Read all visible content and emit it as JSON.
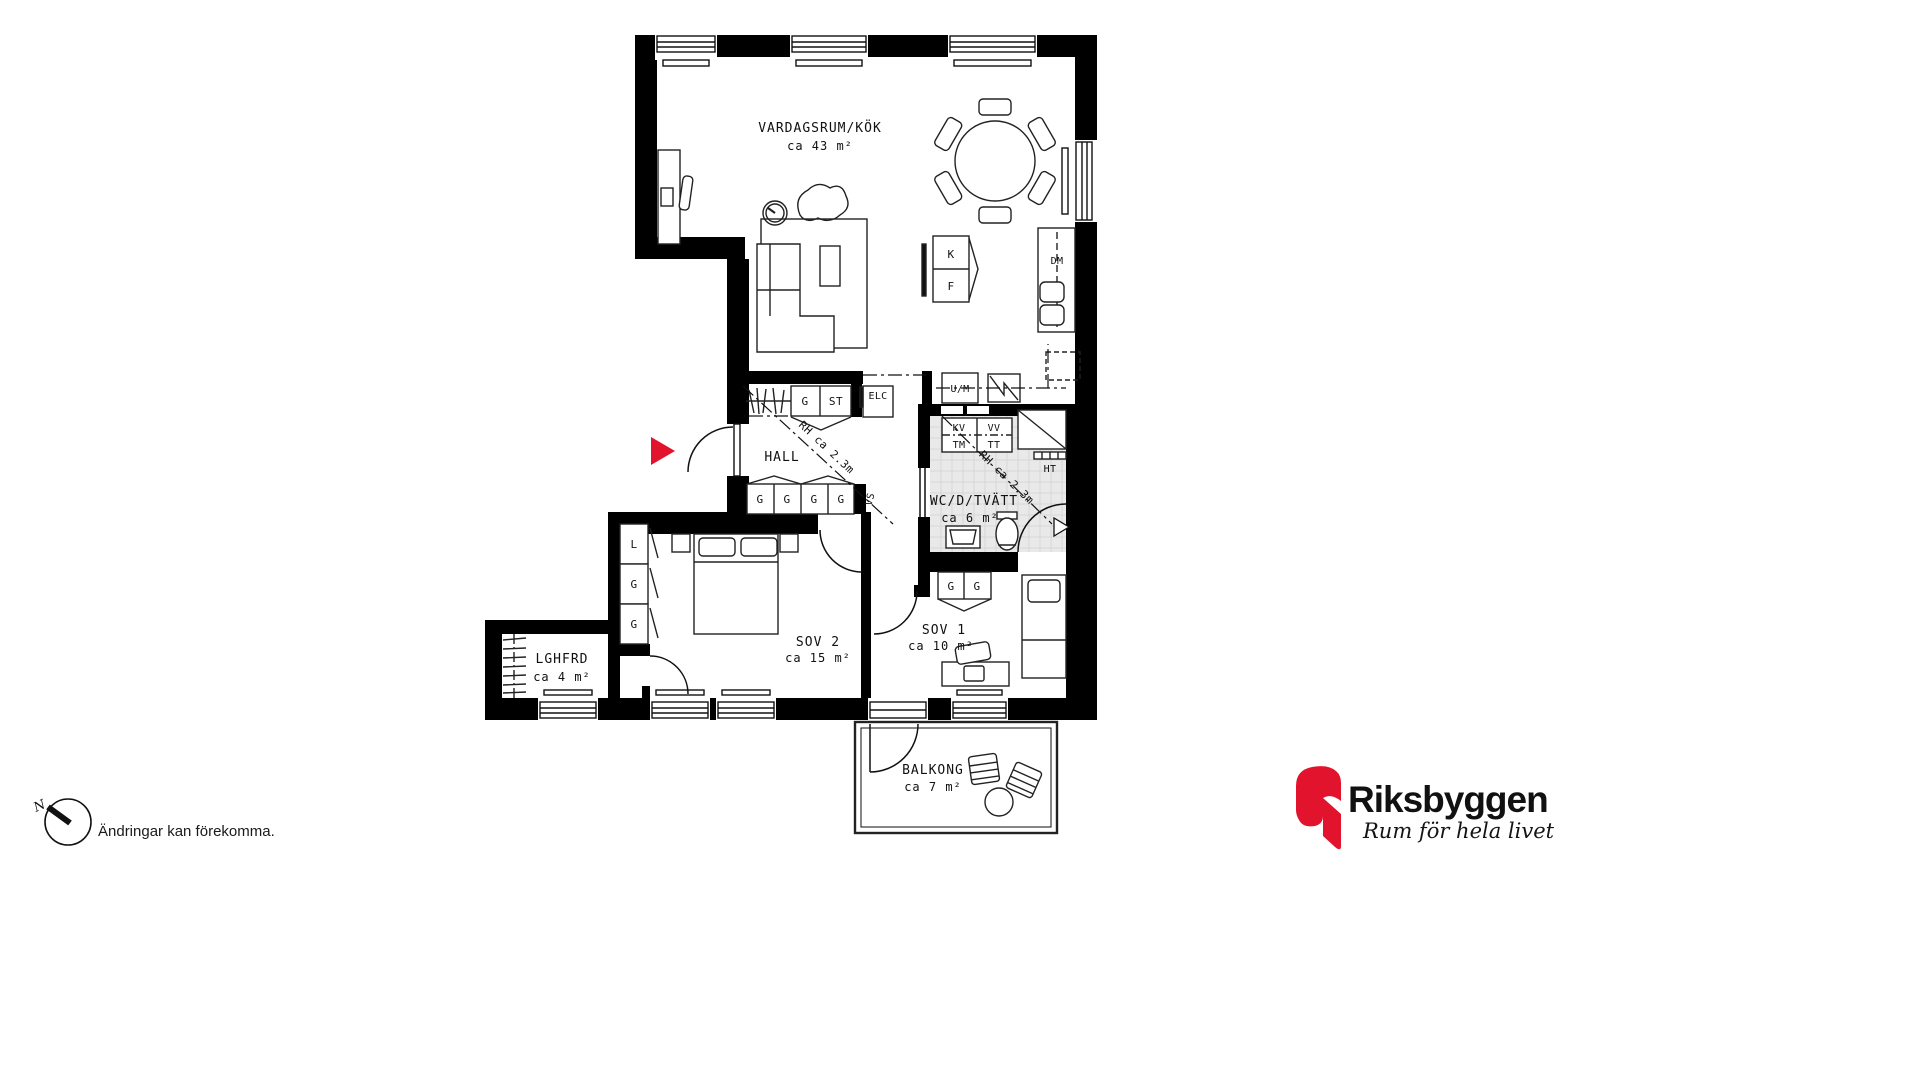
{
  "plan": {
    "rooms": {
      "living": {
        "name": "VARDAGSRUM/KÖK",
        "area": "ca 43 m²"
      },
      "hall": {
        "name": "HALL"
      },
      "wc": {
        "name": "WC/D/TVÄTT",
        "area": "ca 6 m²"
      },
      "sov2": {
        "name": "SOV 2",
        "area": "ca 15 m²"
      },
      "sov1": {
        "name": "SOV 1",
        "area": "ca 10 m²"
      },
      "lghfrd": {
        "name": "LGHFRD",
        "area": "ca 4 m²"
      },
      "balkong": {
        "name": "BALKONG",
        "area": "ca 7 m²"
      }
    },
    "fixtures": {
      "fridge": "K",
      "freezer": "F",
      "dishwasher": "DM",
      "washer_micro": "U/M",
      "electrical": "ELC",
      "shaft": "VS",
      "towel_dryer": "HT",
      "hall_top_cabinets": [
        "G",
        "ST"
      ],
      "hall_cabinets": [
        "G",
        "G",
        "G",
        "G"
      ],
      "laundry_top": [
        "KV",
        "VV"
      ],
      "laundry_machines": [
        "TM",
        "TT"
      ],
      "sov2_wardrobe": [
        "L",
        "G",
        "G"
      ],
      "sov1_cabinets": [
        "G",
        "G"
      ]
    },
    "annotations": {
      "ceiling_height": "RH ca 2.3m"
    },
    "compass": {
      "north": "N"
    },
    "disclaimer": "Ändringar kan förekomma."
  },
  "footer_logo": {
    "brand": "Riksbyggen",
    "tagline": "Rum för hela livet"
  },
  "colors": {
    "accent_red": "#e2142d",
    "logo_gray": "#9b9b9b",
    "line_black": "#111111",
    "tile_gray": "#e9e9e9"
  }
}
